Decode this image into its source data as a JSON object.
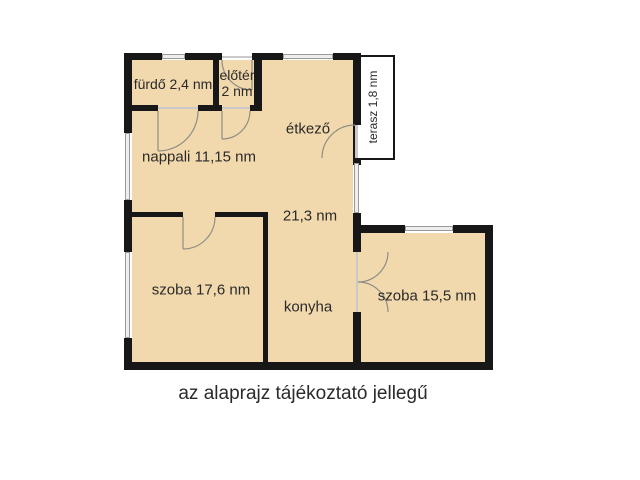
{
  "title": "floor plan",
  "colors": {
    "bg": "#ffffff",
    "floor": "#f2d9ad",
    "wall": "#171717",
    "window_fill": "#efeeec",
    "window_border": "#9a9a9a",
    "door": "#8f8f85",
    "text": "#2a2a2a"
  },
  "rooms": {
    "furdo": {
      "label": "fürdő 2,4 nm"
    },
    "eloter": {
      "label_line1": "előtér",
      "label_line2": "2 nm"
    },
    "etkezo": {
      "label": "étkező"
    },
    "terasz": {
      "label": "terasz 1,8 nm"
    },
    "nappali": {
      "label": "nappali 11,15 nm"
    },
    "center": {
      "label": "21,3 nm"
    },
    "szoba1": {
      "label": "szoba 17,6 nm"
    },
    "konyha": {
      "label": "konyha"
    },
    "szoba2": {
      "label": "szoba 15,5 nm"
    }
  },
  "caption": "az alaprajz tájékoztató jellegű"
}
